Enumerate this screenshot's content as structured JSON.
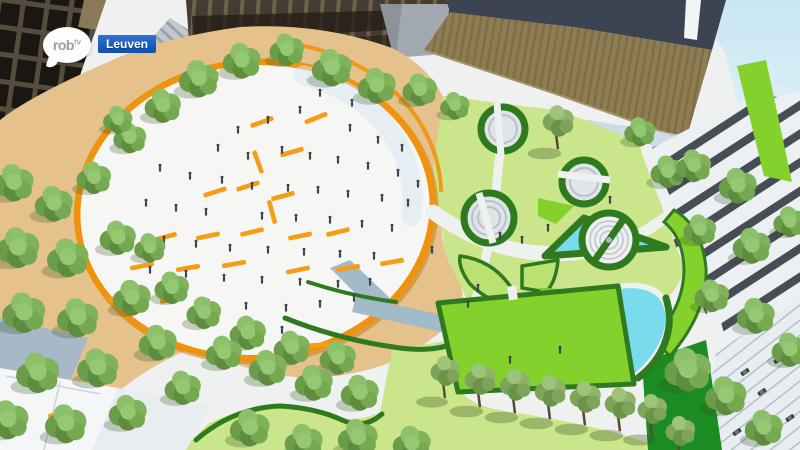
{
  "broadcast": {
    "station_logo": {
      "main": "rob",
      "sup": "tv"
    },
    "location_badge": {
      "label": "Leuven"
    }
  },
  "scene": {
    "description": "Aerial 3D architectural rendering of a redesigned city square in Leuven: large circular white plaza ringed in orange with benches and people, tree groves, lawns with circular hedge planters, an amphitheatre, triangular and teardrop pools, market canopies and parking at right",
    "palette": {
      "sky_blue": "#cfe8f4",
      "paving_white": "#eef1ef",
      "shadow_blue": "#c6d6e4",
      "tan_gravel": "#e5c18b",
      "lawn_light": "#cbe68a",
      "lawn_bright": "#84d12d",
      "hedge_green": "#2f7a1e",
      "pool_cyan": "#79dcec",
      "plaza_white": "#f6f7f5",
      "ring_orange": "#ef930e",
      "bench_orange": "#f59d15",
      "water_rill": "#a3bac9",
      "person_dark": "#3f444b",
      "badge_blue_top": "#2f72d2",
      "badge_blue_bottom": "#0f4fae"
    },
    "trees": [
      [
        163,
        106,
        1.05
      ],
      [
        199,
        79,
        1.15
      ],
      [
        242,
        61,
        1.1
      ],
      [
        287,
        50,
        1.0
      ],
      [
        332,
        68,
        1.15
      ],
      [
        377,
        86,
        1.1
      ],
      [
        420,
        90,
        1.0
      ],
      [
        455,
        106,
        0.85
      ],
      [
        130,
        138,
        0.95
      ],
      [
        118,
        120,
        0.85
      ],
      [
        14,
        183,
        1.15
      ],
      [
        54,
        204,
        1.1
      ],
      [
        94,
        178,
        1.0
      ],
      [
        18,
        248,
        1.25
      ],
      [
        68,
        258,
        1.2
      ],
      [
        118,
        238,
        1.05
      ],
      [
        24,
        313,
        1.25
      ],
      [
        78,
        318,
        1.2
      ],
      [
        132,
        298,
        1.1
      ],
      [
        38,
        373,
        1.25
      ],
      [
        98,
        368,
        1.2
      ],
      [
        158,
        343,
        1.1
      ],
      [
        8,
        420,
        1.2
      ],
      [
        66,
        424,
        1.2
      ],
      [
        128,
        413,
        1.1
      ],
      [
        183,
        388,
        1.05
      ],
      [
        172,
        288,
        1.0
      ],
      [
        150,
        248,
        0.9
      ],
      [
        204,
        313,
        1.0
      ],
      [
        248,
        333,
        1.05
      ],
      [
        292,
        348,
        1.05
      ],
      [
        338,
        358,
        1.05
      ],
      [
        224,
        353,
        1.05
      ],
      [
        268,
        368,
        1.1
      ],
      [
        314,
        383,
        1.1
      ],
      [
        360,
        393,
        1.1
      ],
      [
        250,
        428,
        1.15
      ],
      [
        304,
        442,
        1.1
      ],
      [
        358,
        438,
        1.15
      ],
      [
        412,
        444,
        1.1
      ],
      [
        558,
        122,
        1.05,
        2
      ],
      [
        640,
        132,
        0.9
      ],
      [
        668,
        172,
        1.0
      ],
      [
        694,
        166,
        1.0
      ],
      [
        738,
        186,
        1.1
      ],
      [
        700,
        230,
        0.95
      ],
      [
        752,
        246,
        1.1
      ],
      [
        790,
        222,
        0.95
      ],
      [
        712,
        296,
        1.0
      ],
      [
        756,
        316,
        1.1
      ],
      [
        790,
        350,
        1.05
      ],
      [
        688,
        370,
        1.35
      ],
      [
        726,
        396,
        1.2
      ],
      [
        764,
        428,
        1.1
      ],
      [
        445,
        372,
        1.0,
        2
      ],
      [
        480,
        380,
        1.05,
        2
      ],
      [
        515,
        386,
        1.05,
        2
      ],
      [
        550,
        392,
        1.05,
        2
      ],
      [
        585,
        398,
        1.05,
        2
      ],
      [
        620,
        404,
        1.05,
        2
      ],
      [
        652,
        410,
        1.0,
        2
      ],
      [
        680,
        432,
        1.0,
        2
      ]
    ],
    "benches": [
      [
        215,
        192,
        -18
      ],
      [
        248,
        186,
        -18
      ],
      [
        283,
        196,
        -15
      ],
      [
        262,
        122,
        -20
      ],
      [
        292,
        152,
        -16
      ],
      [
        316,
        118,
        -22
      ],
      [
        165,
        237,
        -15
      ],
      [
        208,
        236,
        -12
      ],
      [
        252,
        232,
        -14
      ],
      [
        300,
        236,
        -12
      ],
      [
        338,
        232,
        -14
      ],
      [
        142,
        266,
        -12
      ],
      [
        188,
        268,
        -10
      ],
      [
        234,
        264,
        -10
      ],
      [
        298,
        270,
        -12
      ],
      [
        348,
        268,
        -10
      ],
      [
        392,
        262,
        -10
      ],
      [
        120,
        298,
        -8
      ],
      [
        172,
        300,
        -8
      ],
      [
        258,
        162,
        70
      ],
      [
        272,
        212,
        75
      ],
      [
        250,
        337,
        -6
      ],
      [
        318,
        345,
        -4
      ],
      [
        60,
        414,
        -12
      ]
    ],
    "people": [
      [
        320,
        95
      ],
      [
        352,
        105
      ],
      [
        300,
        112
      ],
      [
        268,
        122
      ],
      [
        238,
        132
      ],
      [
        350,
        130
      ],
      [
        378,
        142
      ],
      [
        402,
        150
      ],
      [
        218,
        150
      ],
      [
        248,
        158
      ],
      [
        282,
        152
      ],
      [
        310,
        158
      ],
      [
        338,
        162
      ],
      [
        368,
        168
      ],
      [
        398,
        175
      ],
      [
        418,
        186
      ],
      [
        160,
        170
      ],
      [
        190,
        178
      ],
      [
        222,
        182
      ],
      [
        252,
        188
      ],
      [
        288,
        190
      ],
      [
        318,
        192
      ],
      [
        348,
        196
      ],
      [
        382,
        200
      ],
      [
        408,
        205
      ],
      [
        146,
        205
      ],
      [
        176,
        210
      ],
      [
        206,
        214
      ],
      [
        262,
        218
      ],
      [
        296,
        220
      ],
      [
        330,
        222
      ],
      [
        362,
        226
      ],
      [
        392,
        230
      ],
      [
        132,
        238
      ],
      [
        164,
        242
      ],
      [
        196,
        246
      ],
      [
        230,
        250
      ],
      [
        268,
        252
      ],
      [
        304,
        254
      ],
      [
        340,
        256
      ],
      [
        374,
        258
      ],
      [
        150,
        272
      ],
      [
        186,
        276
      ],
      [
        224,
        280
      ],
      [
        262,
        282
      ],
      [
        300,
        284
      ],
      [
        338,
        286
      ],
      [
        370,
        284
      ],
      [
        208,
        305
      ],
      [
        246,
        308
      ],
      [
        286,
        310
      ],
      [
        320,
        306
      ],
      [
        354,
        300
      ],
      [
        240,
        330
      ],
      [
        282,
        332
      ],
      [
        500,
        238
      ],
      [
        522,
        242
      ],
      [
        548,
        230
      ],
      [
        610,
        202
      ],
      [
        478,
        290
      ],
      [
        432,
        252
      ],
      [
        560,
        352
      ],
      [
        468,
        306
      ],
      [
        510,
        362
      ]
    ],
    "cars": [
      [
        745,
        372
      ],
      [
        762,
        392
      ],
      [
        778,
        360
      ],
      [
        790,
        418
      ],
      [
        737,
        432
      ]
    ]
  }
}
